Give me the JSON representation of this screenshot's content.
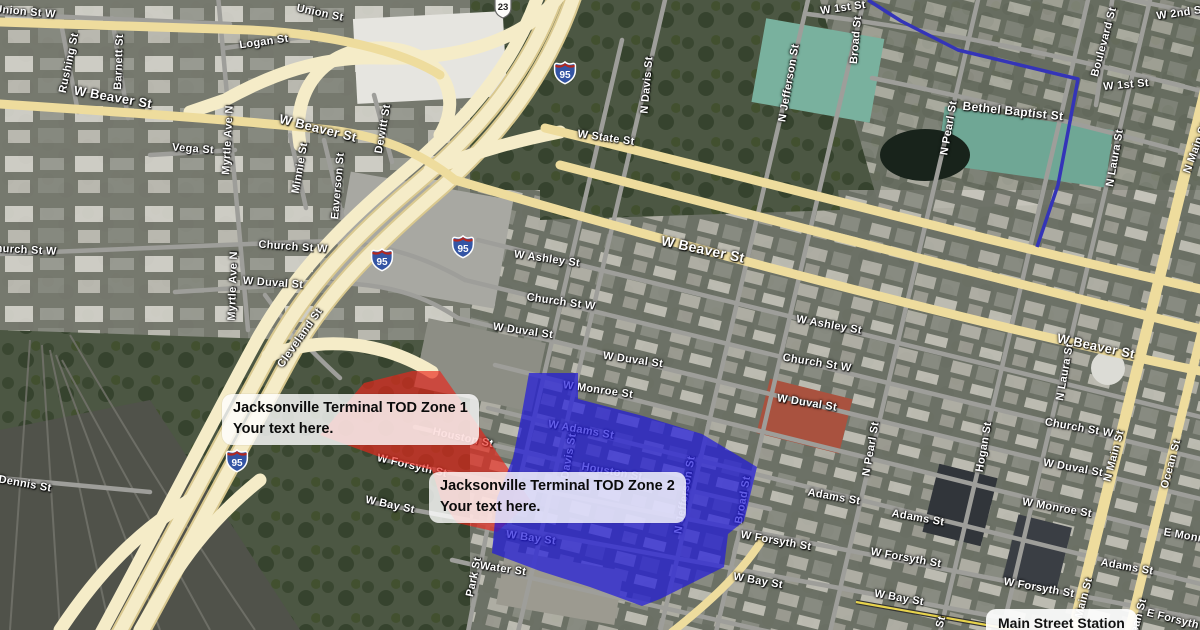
{
  "zones": [
    {
      "id": "zone1",
      "title": "Jacksonville Terminal TOD Zone 1",
      "subtitle": "Your text here.",
      "color": "#e9261b",
      "opacity": "0.66",
      "polygon": "364,383 412,371 440,371 531,501 497,532 457,523 441,500 432,470 377,456 320,435"
    },
    {
      "id": "zone2",
      "title": "Jacksonville Terminal TOD Zone 2",
      "subtitle": "Your text here.",
      "color": "#2018dd",
      "opacity": "0.7",
      "polygon": "529,373 578,373 578,399 643,416 702,434 757,467 744,521 728,534 724,567 660,599 642,606 590,587 540,571 492,553 497,498 513,458 521,418"
    }
  ],
  "station": {
    "label": "Main Street Station"
  },
  "route": {
    "color": "#3434b8",
    "points": "868,0 901,21 958,50 1078,79 1058,185 1037,247"
  },
  "shields": [
    {
      "kind": "i95",
      "label": "95",
      "x": 565,
      "y": 74
    },
    {
      "kind": "i95",
      "label": "95",
      "x": 463,
      "y": 248
    },
    {
      "kind": "i95",
      "label": "95",
      "x": 382,
      "y": 261
    },
    {
      "kind": "i95",
      "label": "95",
      "x": 237,
      "y": 462
    },
    {
      "kind": "us23",
      "label": "23",
      "x": 503,
      "y": 10
    }
  ],
  "street_labels": [
    {
      "t": "Union St W",
      "x": 25,
      "y": 12,
      "r": 5
    },
    {
      "t": "Union St",
      "x": 320,
      "y": 13,
      "r": 12
    },
    {
      "t": "Logan St",
      "x": 264,
      "y": 42,
      "r": -8
    },
    {
      "t": "Rushing St",
      "x": 69,
      "y": 63,
      "r": -78
    },
    {
      "t": "Barnett St",
      "x": 119,
      "y": 62,
      "r": -88
    },
    {
      "t": "W Beaver St",
      "x": 113,
      "y": 97,
      "r": 10,
      "s": 13
    },
    {
      "t": "W Beaver St",
      "x": 318,
      "y": 128,
      "r": 14,
      "s": 13
    },
    {
      "t": "Vega St",
      "x": 193,
      "y": 149,
      "r": 4
    },
    {
      "t": "Myrtle Ave N",
      "x": 228,
      "y": 140,
      "r": -87
    },
    {
      "t": "Minnie St",
      "x": 300,
      "y": 168,
      "r": -80
    },
    {
      "t": "Dewitt St",
      "x": 383,
      "y": 129,
      "r": -80
    },
    {
      "t": "Eaverson St",
      "x": 338,
      "y": 186,
      "r": -85
    },
    {
      "t": "Church St W",
      "x": 22,
      "y": 250,
      "r": 3
    },
    {
      "t": "Church St W",
      "x": 293,
      "y": 247,
      "r": 4
    },
    {
      "t": "W Duval St",
      "x": 273,
      "y": 283,
      "r": 4
    },
    {
      "t": "Myrtle Ave N",
      "x": 233,
      "y": 286,
      "r": -88
    },
    {
      "t": "Cleveland St",
      "x": 300,
      "y": 338,
      "r": -55
    },
    {
      "t": "Dennis St",
      "x": 25,
      "y": 484,
      "r": 10
    },
    {
      "t": "Park St",
      "x": 474,
      "y": 577,
      "r": -78
    },
    {
      "t": "Water St",
      "x": 503,
      "y": 569,
      "r": 8
    },
    {
      "t": "W State St",
      "x": 606,
      "y": 138,
      "r": 8
    },
    {
      "t": "N Davis St",
      "x": 647,
      "y": 85,
      "r": -85
    },
    {
      "t": "N Jefferson St",
      "x": 789,
      "y": 83,
      "r": -80
    },
    {
      "t": "W Ashley St",
      "x": 547,
      "y": 259,
      "r": 8
    },
    {
      "t": "Church St W",
      "x": 561,
      "y": 302,
      "r": 8
    },
    {
      "t": "W Duval St",
      "x": 523,
      "y": 331,
      "r": 8
    },
    {
      "t": "W Duval St",
      "x": 633,
      "y": 360,
      "r": 8
    },
    {
      "t": "W Monroe St",
      "x": 598,
      "y": 390,
      "r": 8
    },
    {
      "t": "W Beaver St",
      "x": 703,
      "y": 249,
      "r": 12,
      "s": 14
    },
    {
      "t": "W Ashley St",
      "x": 829,
      "y": 325,
      "r": 10
    },
    {
      "t": "Church St W",
      "x": 817,
      "y": 363,
      "r": 9
    },
    {
      "t": "W Duval St",
      "x": 807,
      "y": 403,
      "r": 9
    },
    {
      "t": "W Beaver St",
      "x": 1096,
      "y": 346,
      "r": 12,
      "s": 13
    },
    {
      "t": "N Laura St",
      "x": 1065,
      "y": 372,
      "r": -80
    },
    {
      "t": "N Pearl St",
      "x": 871,
      "y": 449,
      "r": -80
    },
    {
      "t": "Hogan St",
      "x": 984,
      "y": 447,
      "r": -80
    },
    {
      "t": "N Main St",
      "x": 1114,
      "y": 456,
      "r": -75
    },
    {
      "t": "Ocean St",
      "x": 1171,
      "y": 464,
      "r": -75
    },
    {
      "t": "N Laura St",
      "x": 1115,
      "y": 158,
      "r": -80
    },
    {
      "t": "Boulevard St",
      "x": 1104,
      "y": 42,
      "r": -75
    },
    {
      "t": "N Pearl St",
      "x": 949,
      "y": 128,
      "r": -80
    },
    {
      "t": "Broad St",
      "x": 856,
      "y": 40,
      "r": -85
    },
    {
      "t": "N Main St",
      "x": 1196,
      "y": 148,
      "r": -70
    },
    {
      "t": "N Jefferson St",
      "x": 685,
      "y": 495,
      "r": -80
    },
    {
      "t": "Davis St",
      "x": 569,
      "y": 456,
      "r": -80
    },
    {
      "t": "Broad St",
      "x": 743,
      "y": 500,
      "r": -80
    },
    {
      "t": "Church St W",
      "x": 1079,
      "y": 428,
      "r": 10
    },
    {
      "t": "W Duval St",
      "x": 1073,
      "y": 468,
      "r": 10
    },
    {
      "t": "Adams St",
      "x": 834,
      "y": 497,
      "r": 10
    },
    {
      "t": "Adams St",
      "x": 918,
      "y": 518,
      "r": 10
    },
    {
      "t": "W Monroe St",
      "x": 1057,
      "y": 508,
      "r": 10
    },
    {
      "t": "E Monroe St",
      "x": 1197,
      "y": 538,
      "r": 10
    },
    {
      "t": "W Forsyth St",
      "x": 906,
      "y": 558,
      "r": 10
    },
    {
      "t": "Adams St",
      "x": 1127,
      "y": 567,
      "r": 10
    },
    {
      "t": "W Bay St",
      "x": 899,
      "y": 598,
      "r": 10
    },
    {
      "t": "W Forsyth St",
      "x": 1039,
      "y": 588,
      "r": 10
    },
    {
      "t": "Main St",
      "x": 1084,
      "y": 598,
      "r": -75
    },
    {
      "t": "Ocean St",
      "x": 1137,
      "y": 623,
      "r": -75
    },
    {
      "t": "E Forsyth St",
      "x": 1180,
      "y": 621,
      "r": 14
    },
    {
      "t": "St",
      "x": 941,
      "y": 622,
      "r": -75
    },
    {
      "t": "W 1st St",
      "x": 843,
      "y": 8,
      "r": -8
    },
    {
      "t": "W 1st St",
      "x": 1126,
      "y": 85,
      "r": -5
    },
    {
      "t": "W 2nd St",
      "x": 1181,
      "y": 13,
      "r": -8
    },
    {
      "t": "Bethel Baptist St",
      "x": 1013,
      "y": 111,
      "r": 6,
      "s": 12
    },
    {
      "t": "Houston St",
      "x": 463,
      "y": 438,
      "r": 12
    },
    {
      "t": "W Forsyth St",
      "x": 412,
      "y": 466,
      "r": 13
    },
    {
      "t": "W Adams St",
      "x": 581,
      "y": 430,
      "r": 10
    },
    {
      "t": "Houston St",
      "x": 612,
      "y": 472,
      "r": 10
    },
    {
      "t": "W Bay St",
      "x": 531,
      "y": 538,
      "r": 8
    },
    {
      "t": "W Bay St",
      "x": 390,
      "y": 505,
      "r": 12
    },
    {
      "t": "W Bay St",
      "x": 758,
      "y": 581,
      "r": 10
    },
    {
      "t": "W Forsyth St",
      "x": 776,
      "y": 541,
      "r": 10
    }
  ]
}
